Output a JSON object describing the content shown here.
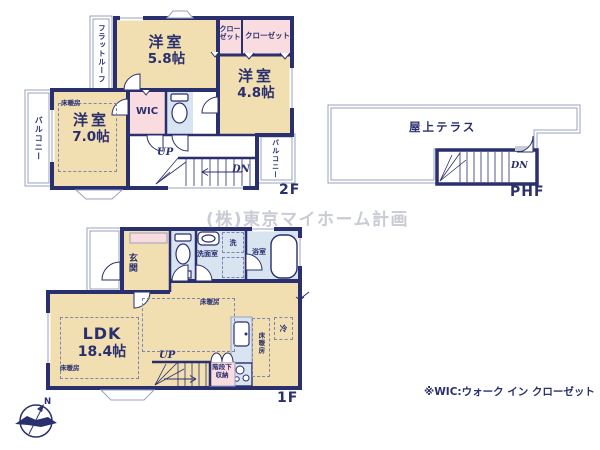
{
  "watermark": "(株)東京マイホーム計画",
  "footnote": "※WIC:ウォーク イン クローゼット",
  "compass": {
    "north": "N"
  },
  "colors": {
    "wall": "#2a2f6e",
    "room": "#f1dfb2",
    "closet": "#f8dcdf",
    "wet": "#d8e4f0",
    "outline": "#9aa1bf",
    "watermark": "#c9cbd5"
  },
  "floor2f": {
    "label": "2F",
    "flat_roof": "フラットルーフ",
    "balcony_left": "バルコニー",
    "balcony_right": "バルコニー",
    "bedroom_a": {
      "name": "洋室",
      "size": "5.8帖"
    },
    "bedroom_b": {
      "name": "洋室",
      "size": "4.8帖"
    },
    "bedroom_c": {
      "name": "洋室",
      "size": "7.0帖"
    },
    "closet_small": "クローゼット",
    "closet_wide": "クローゼット",
    "wic": "WIC",
    "floor_heating": "床暖房",
    "up": "UP",
    "down": "DN"
  },
  "phf": {
    "label": "PHF",
    "roof_terrace": "屋上テラス",
    "down": "DN"
  },
  "floor1f": {
    "label": "1F",
    "entrance": "玄関",
    "washroom": "洗面室",
    "washer": "洗",
    "bathroom": "浴室",
    "ldk": {
      "name": "LDK",
      "size": "18.4帖"
    },
    "floor_heating": "床暖房",
    "fridge": "冷",
    "up": "UP",
    "storage_l1": "階段下",
    "storage_l2": "収納"
  }
}
